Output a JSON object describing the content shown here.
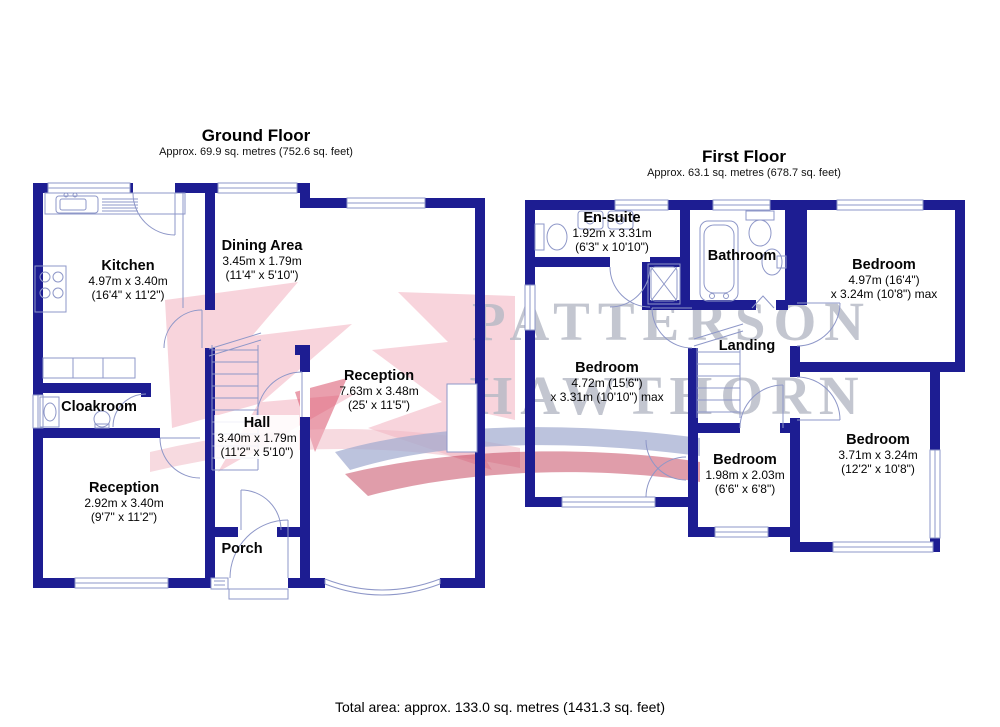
{
  "ground_floor": {
    "title": "Ground Floor",
    "area": "Approx. 69.9 sq. metres (752.6 sq. feet)",
    "rooms": {
      "kitchen": {
        "name": "Kitchen",
        "dim1": "4.97m x 3.40m",
        "dim2": "(16'4\" x 11'2\")"
      },
      "dining": {
        "name": "Dining Area",
        "dim1": "3.45m x 1.79m",
        "dim2": "(11'4\" x 5'10\")"
      },
      "reception_main": {
        "name": "Reception",
        "dim1": "7.63m x 3.48m",
        "dim2": "(25' x 11'5\")"
      },
      "cloakroom": {
        "name": "Cloakroom"
      },
      "hall": {
        "name": "Hall",
        "dim1": "3.40m x 1.79m",
        "dim2": "(11'2\" x 5'10\")"
      },
      "reception_front": {
        "name": "Reception",
        "dim1": "2.92m x 3.40m",
        "dim2": "(9'7\" x 11'2\")"
      },
      "porch": {
        "name": "Porch"
      }
    }
  },
  "first_floor": {
    "title": "First Floor",
    "area": "Approx. 63.1 sq. metres (678.7 sq. feet)",
    "rooms": {
      "ensuite": {
        "name": "En-suite",
        "dim1": "1.92m x 3.31m",
        "dim2": "(6'3\" x 10'10\")"
      },
      "bathroom": {
        "name": "Bathroom"
      },
      "bedroom_top": {
        "name": "Bedroom",
        "dim1": "4.97m (16'4\")",
        "dim2": "x 3.24m (10'8\") max"
      },
      "landing": {
        "name": "Landing"
      },
      "bedroom_left": {
        "name": "Bedroom",
        "dim1": "4.72m (15'6\")",
        "dim2": "x 3.31m (10'10\") max"
      },
      "bedroom_small": {
        "name": "Bedroom",
        "dim1": "1.98m x 2.03m",
        "dim2": "(6'6\" x 6'8\")"
      },
      "bedroom_bottom": {
        "name": "Bedroom",
        "dim1": "3.71m x 3.24m",
        "dim2": "(12'2\" x 10'8\")"
      }
    }
  },
  "footer": {
    "total_area": "Total area: approx. 133.0 sq. metres (1431.3 sq. feet)"
  },
  "watermark": {
    "line1": "PATTERSON",
    "line2": "HAWTHORN"
  },
  "colors": {
    "wall": "#1d1d92",
    "fixture_line": "#8e97c8",
    "watermark_text": "#b5b9c5",
    "logo_pink": "#f3bac6",
    "logo_red": "#d9506a",
    "band_blue": "#9faace",
    "band_red": "#c23b55"
  }
}
